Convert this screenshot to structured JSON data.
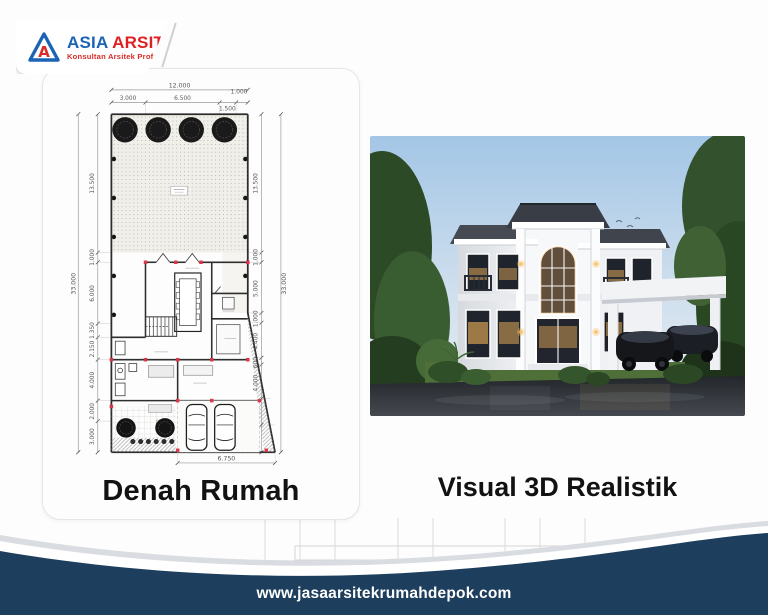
{
  "logo": {
    "brand_first": "ASIA",
    "brand_second": "ARSITEK",
    "tagline": "Konsultan Arsitek Profesional",
    "icon": "triangle-a-logo",
    "colors": {
      "brand_blue": "#1a63b5",
      "brand_red": "#e01f23"
    }
  },
  "left_panel": {
    "title": "Denah Rumah",
    "plan": {
      "dim_top_total": "12.000",
      "dim_top_segments": [
        "3.000",
        "6.500",
        "1.500",
        "1.000"
      ],
      "dim_left_total": "33.000",
      "dim_left_segments": [
        "13.500",
        "1.000",
        "6.000",
        "1.350",
        "2.150",
        "4.000",
        "2.000",
        "3.000"
      ],
      "dim_right_total": "33.000",
      "dim_right_segments": [
        "13.500",
        "1.000",
        "5.000",
        "1.000",
        "4.400",
        "600",
        "4.000",
        "4.500",
        "5.000"
      ],
      "dim_bottom": "6.750",
      "features": [
        "garden-with-trees",
        "dining-table",
        "stairs",
        "double-carport",
        "rear-planting"
      ]
    }
  },
  "right_panel": {
    "title": "Visual 3D Realistik"
  },
  "footer": {
    "website": "www.jasaarsitekrumahdepok.com",
    "bg_color": "#1d3e5d"
  }
}
